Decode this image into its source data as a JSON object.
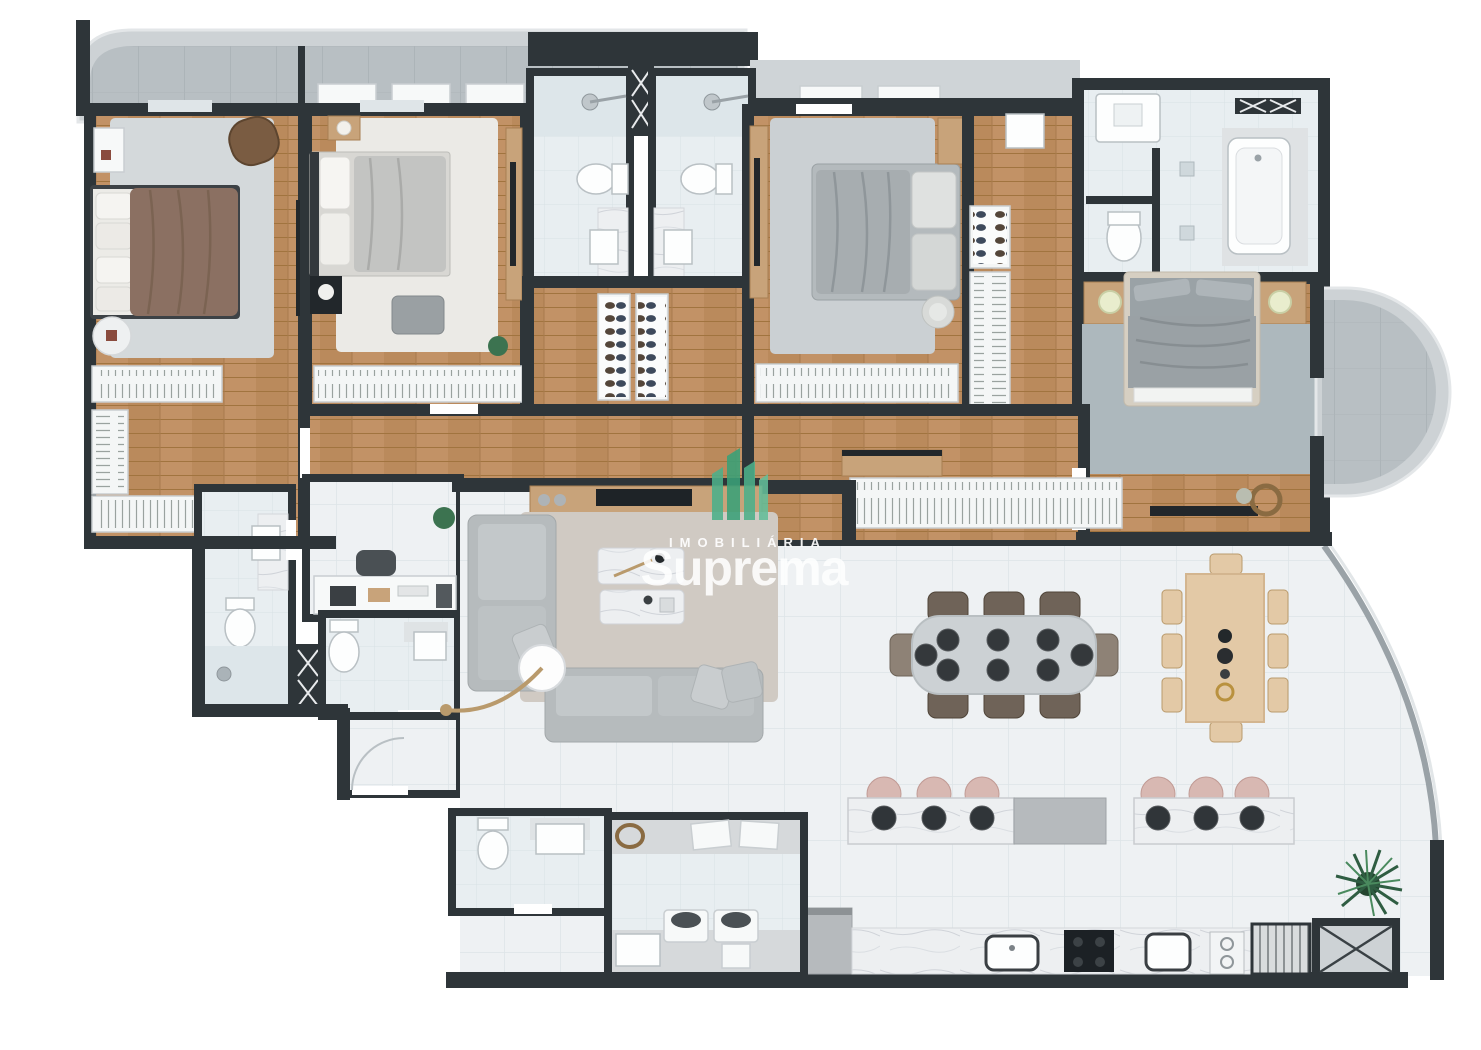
{
  "watermark": {
    "label_top": "IMOBILIÁRIA",
    "label_main": "Suprema",
    "logo_icon": "green-towers-logo"
  },
  "palette": {
    "wall": "#2e3539",
    "outline": "#ffffff",
    "woodDark": "#b07c50",
    "woodLight": "#c29266",
    "tile": "#eef1f3",
    "bathTile": "#e8eef1",
    "balconyFloor": "#b8bfc3",
    "balconyRim": "#cdd2d5",
    "rugLight": "#d4d9db",
    "rugWhite": "#ebeae6",
    "rugGray": "#cbd0d3",
    "rugMaster": "#adb8bd",
    "rugBeige": "#d0cac3",
    "bedBrown": "#8b7062",
    "bedGray": "#a7adb0",
    "pillow": "#ecebe7",
    "sofa": "#b6bbbd",
    "marble": "#edeff1",
    "woodFurniture": "#c8a37a",
    "tableWood": "#e3c9a6",
    "tableGray": "#ccd1d4",
    "chairBrown": "#6f6358",
    "stoolPink": "#d8b8b2",
    "plantGreen": "#3c7350",
    "logoGreen": "#45a981",
    "appliance": "#b6babd",
    "darkAccent": "#22272b",
    "watermarkWhite": "#ffffff"
  }
}
